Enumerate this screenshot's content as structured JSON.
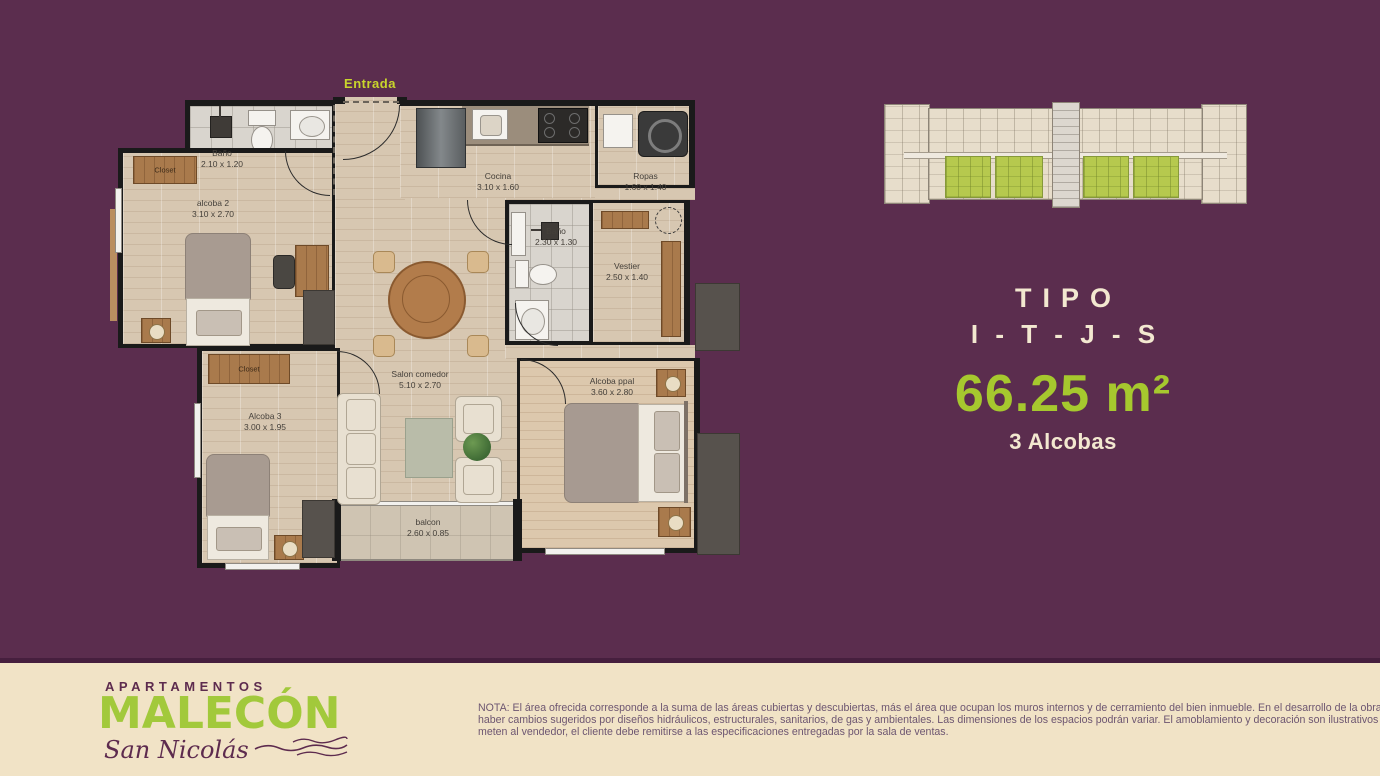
{
  "colors": {
    "background": "#5b2d4e",
    "footer_bg": "#f1e3c6",
    "accent_green": "#a6c82e",
    "entrada_green": "#c9d52c",
    "cream_text": "#f3e8d0",
    "logo_purple": "#5d2b4e",
    "highlight_units_green": "#b6c94e"
  },
  "floor_plan": {
    "entrada_label": "Entrada",
    "closet_label": "Closet",
    "rooms": [
      {
        "name": "Baño",
        "dims": "2.10 x 1.20"
      },
      {
        "name": "alcoba 2",
        "dims": "3.10 x 2.70"
      },
      {
        "name": "Cocina",
        "dims": "3.10 x 1.60"
      },
      {
        "name": "Ropas",
        "dims": "1.60 x 1.40"
      },
      {
        "name": "Baño",
        "dims": "2.30 x 1.30"
      },
      {
        "name": "Vestier",
        "dims": "2.50 x 1.40"
      },
      {
        "name": "Salon comedor",
        "dims": "5.10 x 2.70"
      },
      {
        "name": "Alcoba 3",
        "dims": "3.00 x 1.95"
      },
      {
        "name": "Alcoba ppal",
        "dims": "3.60 x 2.80"
      },
      {
        "name": "balcon",
        "dims": "2.60 x 0.85"
      }
    ]
  },
  "unit_info": {
    "tipo_label": "TIPO",
    "tipo_code": "I - T - J - S",
    "area": "66.25 m²",
    "bedrooms": "3 Alcobas"
  },
  "logo": {
    "line1": "APARTAMENTOS",
    "line2": "MALECÓN",
    "line3": "San Nicolás"
  },
  "note": {
    "lines": [
      "NOTA: El área ofrecida corresponde a la suma de las áreas cubiertas y descubiertas, más el área que ocupan los muros internos y de cerramiento del bien inmueble. En el desarrollo de la obra puede",
      "haber cambios sugeridos por diseños hidráulicos, estructurales, sanitarios, de gas y ambientales. Las dimensiones de los espacios podrán variar. El amoblamiento y decoración son ilustrativos y no compro-",
      "meten al vendedor, el cliente debe remitirse a las especificaciones entregadas por la sala de ventas."
    ]
  }
}
